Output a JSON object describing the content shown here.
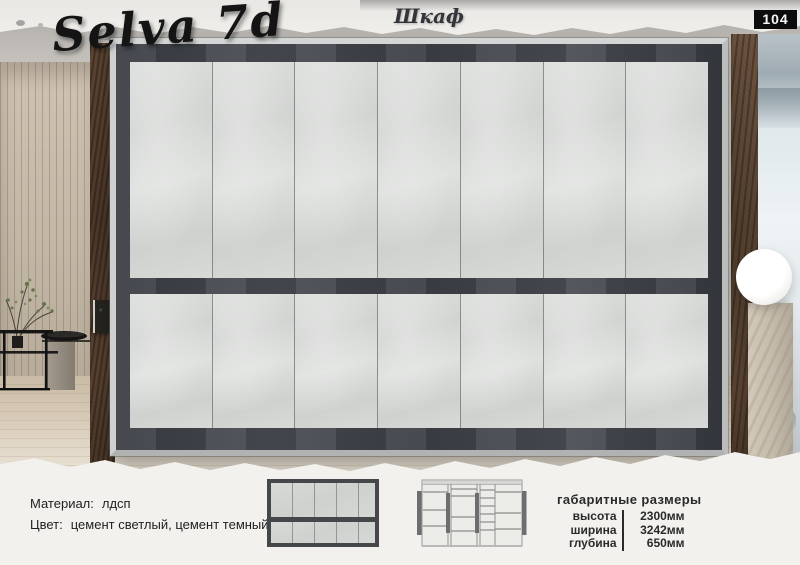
{
  "header": {
    "product_title": "Selva 7d",
    "category": "Шкаф",
    "page_number": "104"
  },
  "specs": {
    "material_label": "Материал:",
    "material_value": "лдсп",
    "color_label": "Цвет:",
    "color_value": "цемент светлый, цемент темный"
  },
  "dimensions": {
    "title": "габаритные размеры",
    "rows": [
      {
        "label": "высота",
        "value": "2300мм"
      },
      {
        "label": "ширина",
        "value": "3242мм"
      },
      {
        "label": "глубина",
        "value": "650мм"
      }
    ]
  },
  "wardrobe": {
    "upper_door_count": 7,
    "lower_door_count": 7,
    "colors": {
      "light_cement": "#d5d7d5",
      "dark_cement": "#3e4147",
      "frame_silver": "#c8cbc9",
      "badge_black": "#0c0c0c"
    }
  }
}
